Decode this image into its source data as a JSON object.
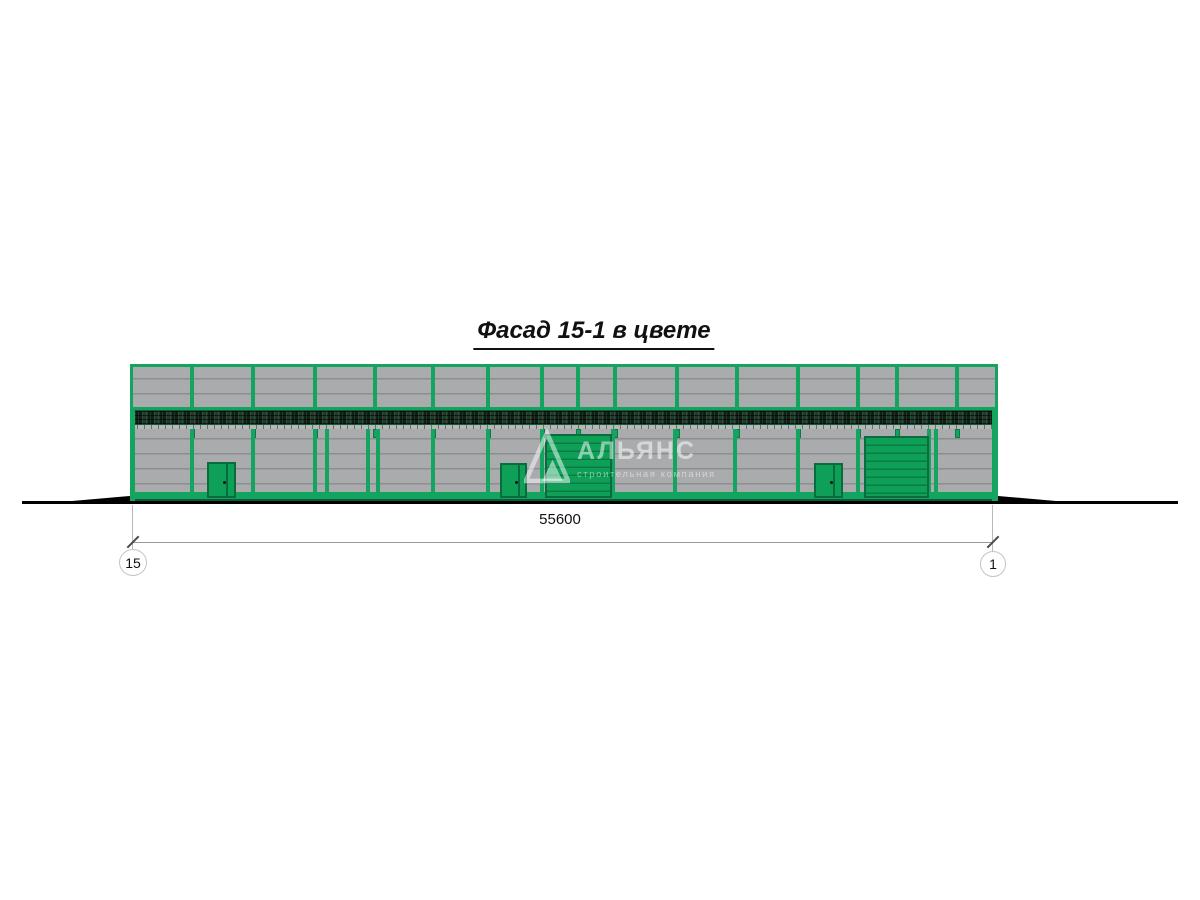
{
  "title": {
    "text": "Фасад 15-1 в цвете"
  },
  "dimension": {
    "label": "55600"
  },
  "axis_markers": {
    "left": "15",
    "right": "1"
  },
  "watermark": {
    "name": "АЛЬЯНС",
    "tagline": "строительная компания"
  },
  "colors": {
    "frame_green": "#13a45f",
    "door_green": "#0fa058",
    "door_border": "#0a6b3e",
    "panel_gray": "#a9abad",
    "panel_line": "#8c8e90",
    "dark_band": "#16291d",
    "ground_black": "#000000"
  },
  "facade": {
    "origin_x": 130,
    "origin_y": 364,
    "mullions_x": [
      192,
      253,
      315,
      375,
      433,
      488,
      542,
      578,
      615,
      677,
      737,
      798,
      858,
      897,
      957
    ],
    "columns_x": [
      192,
      253,
      315,
      327,
      368,
      378,
      433,
      488,
      542,
      613,
      675,
      735,
      798,
      858,
      929,
      936
    ],
    "doors": [
      {
        "x": 207,
        "y": 462,
        "w": 29,
        "h": 36
      },
      {
        "x": 500,
        "y": 463,
        "w": 27,
        "h": 35
      },
      {
        "x": 814,
        "y": 463,
        "w": 29,
        "h": 35
      }
    ],
    "gates": [
      {
        "x": 545,
        "y": 434,
        "w": 67,
        "h": 64
      },
      {
        "x": 864,
        "y": 436,
        "w": 65,
        "h": 62
      }
    ]
  }
}
